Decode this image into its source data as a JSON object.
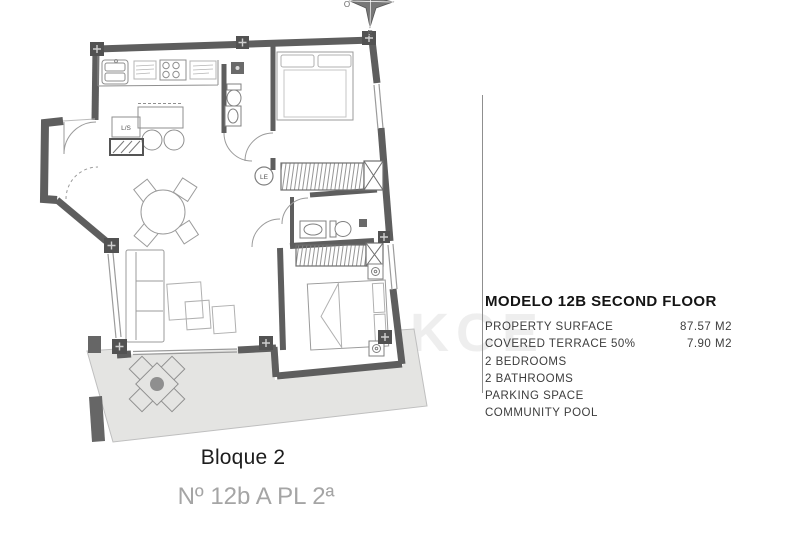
{
  "info_panel": {
    "title": "MODELO 12B SECOND FLOOR",
    "rows": [
      {
        "label": "PROPERTY SURFACE",
        "value": "87.57 M2"
      },
      {
        "label": "COVERED TERRACE 50%",
        "value": "7.90 M2"
      },
      {
        "label": "2 BEDROOMS",
        "value": ""
      },
      {
        "label": "2 BATHROOMS",
        "value": ""
      },
      {
        "label": "PARKING SPACE",
        "value": ""
      },
      {
        "label": "COMMUNITY POOL",
        "value": ""
      }
    ]
  },
  "footer": {
    "block": "Bloque 2",
    "unit": "Nº 12b A PL 2ª"
  },
  "plan": {
    "labels": {
      "laundry": "L/S",
      "linen_closet": "LE"
    },
    "compass": {
      "west": "O",
      "east": "E"
    },
    "watermark": {
      "text": "TEKCE",
      "logo_letter": "T"
    },
    "colors": {
      "wall": "#5e5e5e",
      "pillar": "#525252",
      "terrace": "#e4e4e2",
      "line": "#999999",
      "divider": "#8f8f8f"
    }
  }
}
